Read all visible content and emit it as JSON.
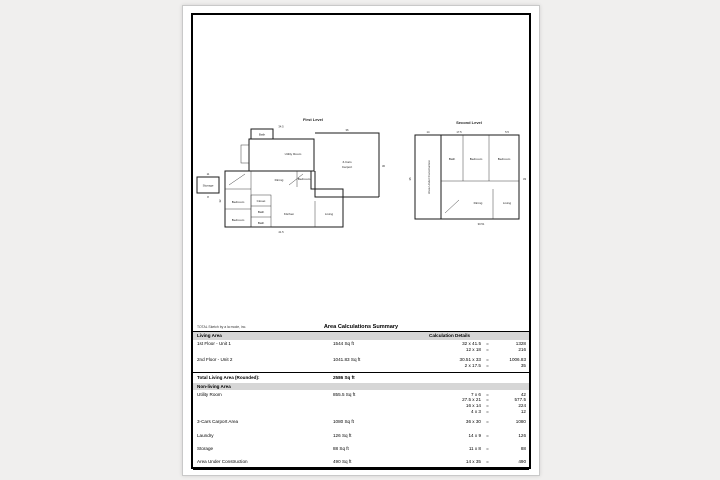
{
  "page": {
    "footer_note": "TOTAL Sketch by a la mode, inc."
  },
  "floorplan": {
    "first": {
      "title": "First Level",
      "storage": "Storage",
      "utility": "Utility Room",
      "bath_top": "Bath",
      "bedroom1": "Bedroom",
      "bedroom2": "Bedroom",
      "bedroom3": "Bedroom",
      "closet": "Closet",
      "bath1": "Bath",
      "bath2": "Bath",
      "dining": "Dining",
      "kitchen": "Kitchen",
      "living": "Living",
      "carport_line1": "3-Cars",
      "carport_line2": "Carport",
      "dims": {
        "top": "34.5",
        "carport_top": "36",
        "carport_right": "30",
        "bottom": "41.5",
        "left": "32",
        "storage_top": "11",
        "storage_bottom": "8"
      }
    },
    "second": {
      "title": "Second Level",
      "construction": "Area Under Construction",
      "bath": "Bath",
      "bedroom1": "Bedroom",
      "bedroom2": "Bedroom",
      "dining": "Dining",
      "living": "Living",
      "dims": {
        "top_left": "14",
        "top_mid": "17.5",
        "top_right": "5.5",
        "left": "35",
        "right": "33",
        "bottom": "30.51"
      }
    }
  },
  "table": {
    "title": "Area Calculations Summary",
    "col_living": "Living Area",
    "col_calc": "Calculation Details",
    "equals": "=",
    "living_rows": [
      {
        "label": "1st Floor - Unit 1",
        "value": "1544 Sq ft",
        "calcs": [
          {
            "expr": "32 x 41.5",
            "result": "1328"
          },
          {
            "expr": "12 x 18",
            "result": "216"
          }
        ]
      },
      {
        "label": "2nd Floor - Unit 2",
        "value": "1041.83 Sq ft",
        "calcs": [
          {
            "expr": "30.51 x 33",
            "result": "1006.83"
          },
          {
            "expr": "2 x 17.5",
            "result": "35"
          }
        ]
      }
    ],
    "total_label": "Total Living Area (Rounded):",
    "total_value": "2586 Sq ft",
    "nonliving_header": "Non-living Area",
    "nonliving_rows": [
      {
        "label": "Utility Room",
        "value": "855.5 Sq ft",
        "calcs": [
          {
            "expr": "7 x 6",
            "result": "42"
          },
          {
            "expr": "27.5 x 21",
            "result": "577.5"
          },
          {
            "expr": "16 x 14",
            "result": "224"
          },
          {
            "expr": "4 x 3",
            "result": "12"
          }
        ]
      },
      {
        "label": "3-Cars Carport Area",
        "value": "1080 Sq ft",
        "calcs": [
          {
            "expr": "36 x 30",
            "result": "1080"
          }
        ]
      },
      {
        "label": "Laundry",
        "value": "126 Sq ft",
        "calcs": [
          {
            "expr": "14 x 9",
            "result": "126"
          }
        ]
      },
      {
        "label": "Storage",
        "value": "88 Sq ft",
        "calcs": [
          {
            "expr": "11 x 8",
            "result": "88"
          }
        ]
      },
      {
        "label": "Area Under Construction",
        "value": "490 Sq ft",
        "calcs": [
          {
            "expr": "14 x 35",
            "result": "490"
          }
        ]
      }
    ]
  }
}
